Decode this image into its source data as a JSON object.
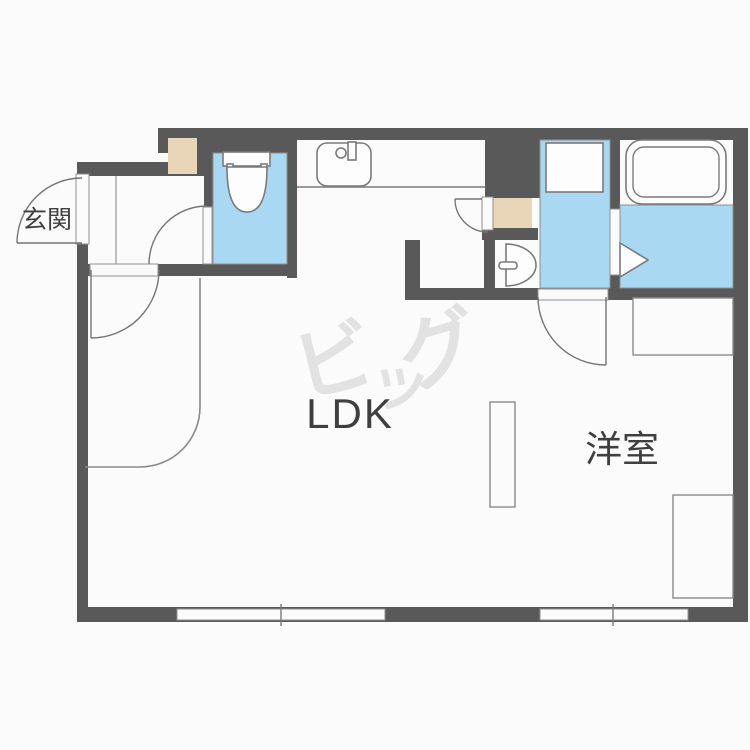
{
  "plan": {
    "labels": {
      "entrance": "玄関",
      "ldk": "LDK",
      "western_room": "洋室"
    },
    "watermark": {
      "char_1": "ビ",
      "char_2": "ッ",
      "char_3": "グ"
    },
    "colors": {
      "wall": "#595959",
      "water_area": "#a9d8f2",
      "cabinet": "#e9d6b8",
      "outline": "#7a7a7a",
      "text": "#3f3f3f",
      "watermark": "#e2e2e2",
      "background": "#fbfbfb"
    },
    "icons": {
      "toilet": "toilet-icon",
      "kitchen_sink": "kitchen-sink-icon",
      "washbasin": "washbasin-icon",
      "bathtub": "bathtub-icon",
      "washing_machine_pan": "washing-machine-pan-icon",
      "entrance_door": "door-swing-icon",
      "window": "window-icon",
      "folding_door": "folding-door-icon"
    }
  }
}
